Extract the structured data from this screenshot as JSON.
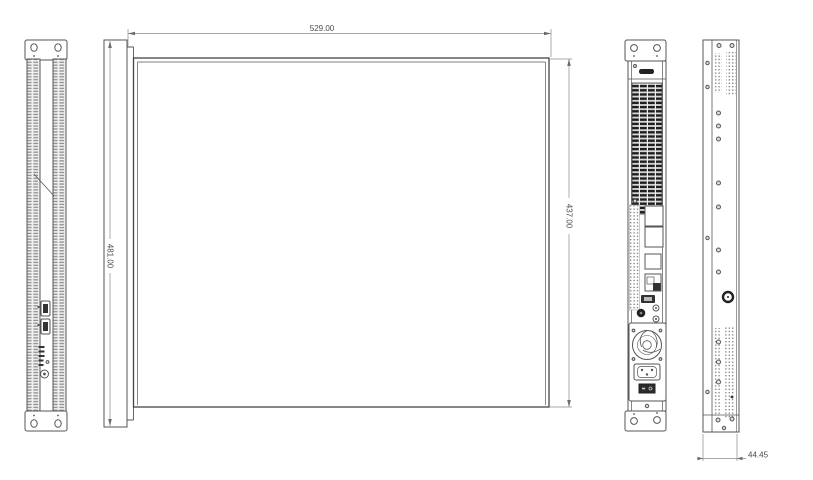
{
  "drawing": {
    "colors": {
      "line": "#555555",
      "heavy_line": "#454545",
      "dark_fill": "#262626",
      "dimension_text": "#4a4a4a",
      "background": "#ffffff"
    },
    "dimensions": {
      "top_width": "529.00",
      "front_panel_width": "481.00",
      "body_width": "437.00",
      "unit_height": "44.45"
    },
    "views": [
      {
        "id": "front-panel-view"
      },
      {
        "id": "top-view"
      },
      {
        "id": "rear-panel-view"
      },
      {
        "id": "side-view"
      }
    ]
  }
}
